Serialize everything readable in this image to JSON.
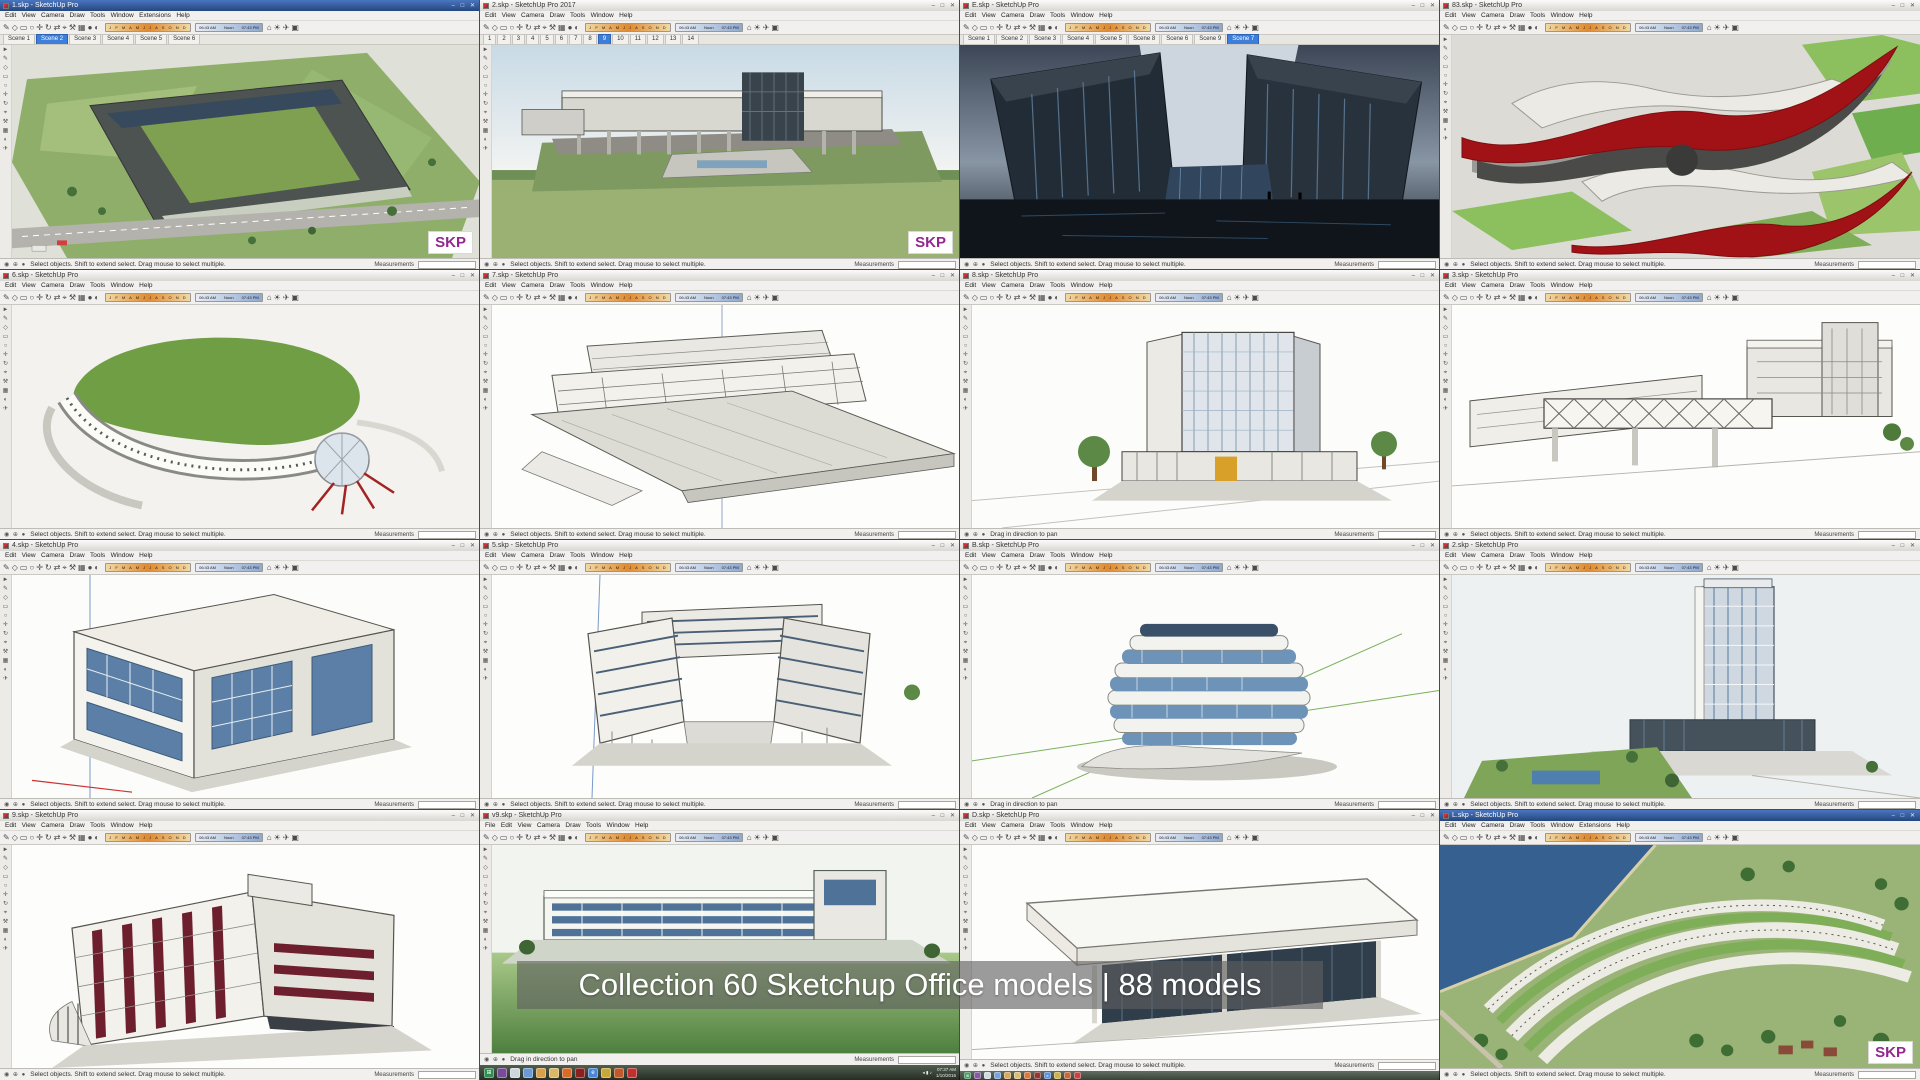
{
  "caption": {
    "text": "Collection 60 Sketchup Office models | 88 models"
  },
  "shared": {
    "watermark": "SKP",
    "menu_standard": "Edit   View   Camera   Draw   Tools   Window   Help",
    "menu_extensions": "Edit   View   Camera   Draw   Tools   Window   Extensions   Help",
    "menu_file": "File   Edit   View   Camera   Draw   Tools   Window   Help",
    "toolbar_glyphs": "✎◇▭○✛↻⇄⌖⚒▦●◐",
    "toolbar_glyphs2": "⌂☀✈▣",
    "toolcol_glyphs": "►\n✎\n◇\n▭\n○\n✛\n↻\n⌖\n⚒\n▦\n◐\n✈",
    "months": "J F M A M J J A S O N D",
    "time_start": "06:43 AM",
    "time_mid": "Noon",
    "time_end": "07:43 PM",
    "status_icons": "◉ ⊕ ●",
    "measurements": "Measurements",
    "controls": "–  □  ✕"
  },
  "status": {
    "select": "Select objects. Shift to extend select. Drag mouse to select multiple.",
    "pan": "Drag in direction to pan"
  },
  "windows": [
    {
      "title": "1.skp - SketchUp Pro",
      "menu": "Edit   View   Camera   Draw   Tools   Window   Extensions   Help",
      "status": "Select objects. Shift to extend select. Drag mouse to select multiple.",
      "tabs": [
        {
          "label": "Scene 1"
        },
        {
          "label": "Scene 2",
          "active": true
        },
        {
          "label": "Scene 3"
        },
        {
          "label": "Scene 4"
        },
        {
          "label": "Scene 5"
        },
        {
          "label": "Scene 6"
        }
      ]
    },
    {
      "title": "2.skp - SketchUp Pro 2017",
      "menu": "Edit   View   Camera   Draw   Tools   Window   Help",
      "status": "Select objects. Shift to extend select. Drag mouse to select multiple.",
      "tabs": [
        {
          "label": "1"
        },
        {
          "label": "2"
        },
        {
          "label": "3"
        },
        {
          "label": "4"
        },
        {
          "label": "5"
        },
        {
          "label": "6"
        },
        {
          "label": "7"
        },
        {
          "label": "8"
        },
        {
          "label": "9",
          "active": true
        },
        {
          "label": "10"
        },
        {
          "label": "11"
        },
        {
          "label": "12"
        },
        {
          "label": "13"
        },
        {
          "label": "14"
        }
      ]
    },
    {
      "title": "E.skp - SketchUp Pro",
      "menu": "Edit   View   Camera   Draw   Tools   Window   Help",
      "status": "Select objects. Shift to extend select. Drag mouse to select multiple.",
      "tabs": [
        {
          "label": "Scene 1"
        },
        {
          "label": "Scene 2"
        },
        {
          "label": "Scene 3"
        },
        {
          "label": "Scene 4"
        },
        {
          "label": "Scene 5"
        },
        {
          "label": "Scene 8"
        },
        {
          "label": "Scene 6"
        },
        {
          "label": "Scene 9"
        },
        {
          "label": "Scene 7",
          "active": true
        }
      ]
    },
    {
      "title": "83.skp - SketchUp Pro",
      "menu": "Edit   View   Camera   Draw   Tools   Window   Help",
      "status": "Select objects. Shift to extend select. Drag mouse to select multiple."
    },
    {
      "title": "6.skp - SketchUp Pro",
      "menu": "Edit   View   Camera   Draw   Tools   Window   Help",
      "status": "Select objects. Shift to extend select. Drag mouse to select multiple."
    },
    {
      "title": "7.skp - SketchUp Pro",
      "menu": "Edit   View   Camera   Draw   Tools   Window   Help",
      "status": "Select objects. Shift to extend select. Drag mouse to select multiple."
    },
    {
      "title": "8.skp - SketchUp Pro",
      "menu": "Edit   View   Camera   Draw   Tools   Window   Help",
      "status": "Drag in direction to pan"
    },
    {
      "title": "3.skp - SketchUp Pro",
      "menu": "Edit   View   Camera   Draw   Tools   Window   Help",
      "status": "Select objects. Shift to extend select. Drag mouse to select multiple."
    },
    {
      "title": "4.skp - SketchUp Pro",
      "menu": "Edit   View   Camera   Draw   Tools   Window   Help",
      "status": "Select objects. Shift to extend select. Drag mouse to select multiple."
    },
    {
      "title": "5.skp - SketchUp Pro",
      "menu": "Edit   View   Camera   Draw   Tools   Window   Help",
      "status": "Select objects. Shift to extend select. Drag mouse to select multiple."
    },
    {
      "title": "B.skp - SketchUp Pro",
      "menu": "Edit   View   Camera   Draw   Tools   Window   Help",
      "status": "Drag in direction to pan"
    },
    {
      "title": "2.skp - SketchUp Pro",
      "menu": "Edit   View   Camera   Draw   Tools   Window   Help",
      "status": "Select objects. Shift to extend select. Drag mouse to select multiple."
    },
    {
      "title": "9.skp - SketchUp Pro",
      "menu": "Edit   View   Camera   Draw   Tools   Window   Help",
      "status": "Select objects. Shift to extend select. Drag mouse to select multiple."
    },
    {
      "title": "v9.skp - SketchUp Pro",
      "menu": "File   Edit   View   Camera   Draw   Tools   Window   Help",
      "status": "Drag in direction to pan"
    },
    {
      "title": "D.skp - SketchUp Pro",
      "menu": "Edit   View   Camera   Draw   Tools   Window   Help",
      "status": "Select objects. Shift to extend select. Drag mouse to select multiple."
    },
    {
      "title": "L.skp - SketchUp Pro",
      "menu": "Edit   View   Camera   Draw   Tools   Window   Extensions   Help",
      "status": "Select objects. Shift to extend select. Drag mouse to select multiple."
    }
  ],
  "taskbar": {
    "tray_time": "07:37 AM",
    "tray_date": "1/10/2016",
    "tray_glyphs": "◂ ▮ ♪",
    "icons": [
      {
        "name": "start-button",
        "color": "#2f8f4f",
        "glyph": "⊞"
      },
      {
        "name": "media-player-icon",
        "color": "#7a4a9a"
      },
      {
        "name": "notepad-icon",
        "color": "#cfd6dd"
      },
      {
        "name": "paint-icon",
        "color": "#6a9ad8"
      },
      {
        "name": "chrome-icon",
        "color": "#d8a04a"
      },
      {
        "name": "folder-icon",
        "color": "#d8b868"
      },
      {
        "name": "firefox-icon",
        "color": "#d86a2a"
      },
      {
        "name": "photoshop-icon",
        "color": "#8a2020"
      },
      {
        "name": "ie-icon",
        "color": "#4a86d8",
        "glyph": "e"
      },
      {
        "name": "office-icon",
        "color": "#c9a83a"
      },
      {
        "name": "powerpoint-icon",
        "color": "#c05a2a"
      },
      {
        "name": "pdf-icon",
        "color": "#c03030"
      }
    ]
  },
  "colors": {
    "skp_watermark": "#93278f",
    "active_tab": "#3d7edb",
    "blue_titlebar": "#24477e",
    "shadow_strip_orange": "#e08a30",
    "glass_blue": "#5b7fa6",
    "model_red": "#a01215",
    "lawn_green": "#7fa558"
  }
}
